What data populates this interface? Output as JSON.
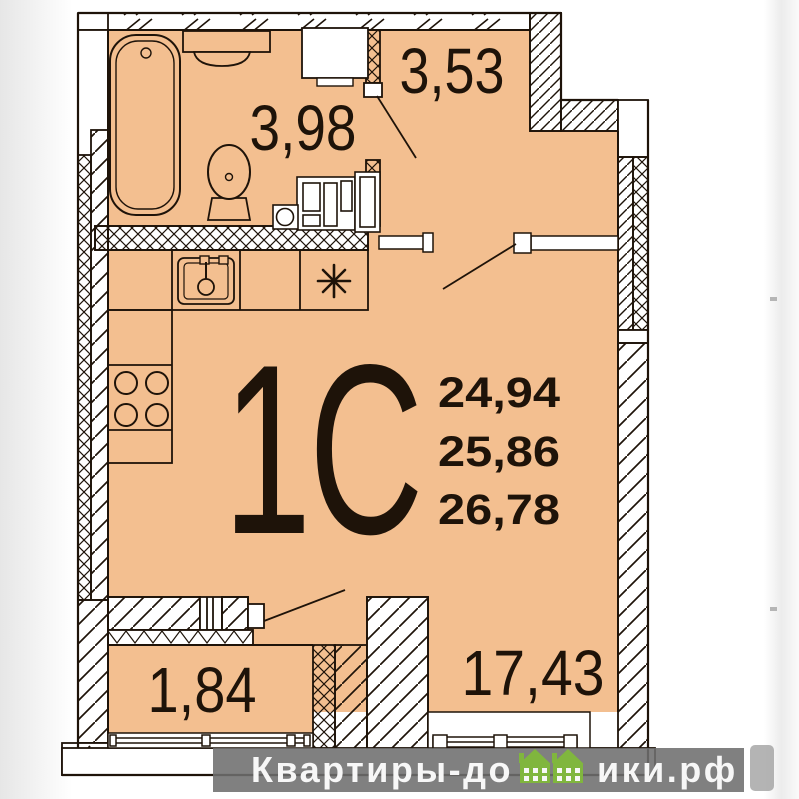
{
  "plan": {
    "unit_label": "1С",
    "area_values": [
      "24,94",
      "25,86",
      "26,78"
    ],
    "rooms": [
      {
        "name": "bathroom",
        "area": "3,98"
      },
      {
        "name": "hallway",
        "area": "3,53"
      },
      {
        "name": "balcony",
        "area": "1,84"
      },
      {
        "name": "living-room",
        "area": "17,43"
      }
    ]
  },
  "watermark": {
    "text_left": "Квартиры-до",
    "text_right": "ики.рф",
    "full_text": "Квартиры-домики.рф",
    "houses_icon": "green-houses-icon",
    "bar_color": "#6e6e6e",
    "text_color": "#f7f7f7",
    "house_green": "#80b63e"
  },
  "colors": {
    "floor": "#f3bf90",
    "line": "#1e1309",
    "background": "#ffffff"
  }
}
